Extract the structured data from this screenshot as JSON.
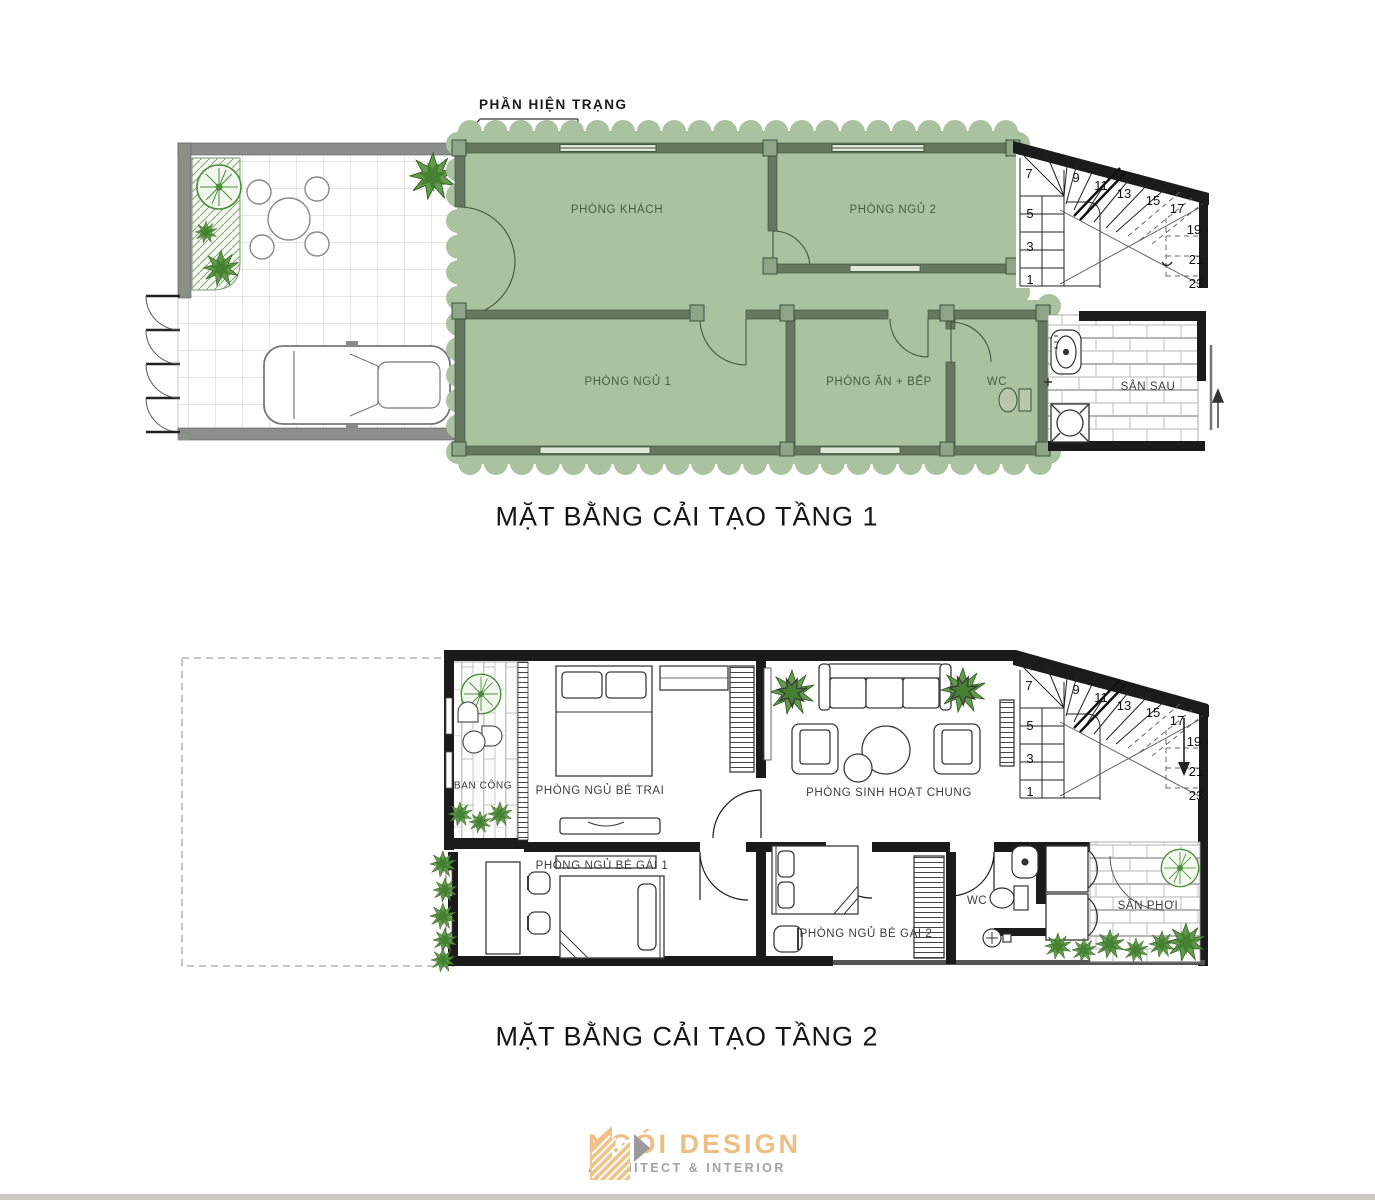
{
  "callout": {
    "label": "PHẦN HIỆN TRẠNG"
  },
  "floor1": {
    "title": "MẶT BẰNG CẢI TẠO TẦNG 1",
    "rooms": {
      "living": "PHÒNG KHÁCH",
      "bedroom2": "PHÒNG NGỦ 2",
      "bedroom1": "PHÒNG NGỦ 1",
      "dining_kitchen": "PHÒNG ĂN + BẾP",
      "wc": "WC",
      "back_yard": "SÂN SAU"
    },
    "stairs": [
      "1",
      "3",
      "5",
      "7",
      "9",
      "11",
      "13",
      "15",
      "17",
      "19",
      "21",
      "23"
    ]
  },
  "floor2": {
    "title": "MẶT BẰNG CẢI TẠO TẦNG 2",
    "rooms": {
      "balcony": "BAN CÔNG",
      "boy_bedroom": "PHÒNG NGỦ BÉ TRAI",
      "family_room": "PHÒNG SINH HOẠT CHUNG",
      "girl_bedroom_1": "PHÒNG NGỦ BÉ GÁI 1",
      "girl_bedroom_2": "PHÒNG NGỦ BÉ GÁI 2",
      "wc": "WC",
      "drying_yard": "SÂN PHƠI"
    },
    "stairs": [
      "1",
      "3",
      "5",
      "7",
      "9",
      "11",
      "13",
      "15",
      "17",
      "19",
      "21",
      "23"
    ]
  },
  "logo": {
    "name": "NGÓI DESIGN",
    "tagline": "ARCHITECT & INTERIOR"
  },
  "colors": {
    "renovation_highlight": "#abc2a0",
    "highlight_wall": "#41553f",
    "wall_black": "#1b1b1b",
    "wall_gray": "#8a8f8a",
    "plant_green": "#57923f",
    "logo_orange": "#edbf85",
    "logo_gray": "#a3a3a3"
  }
}
